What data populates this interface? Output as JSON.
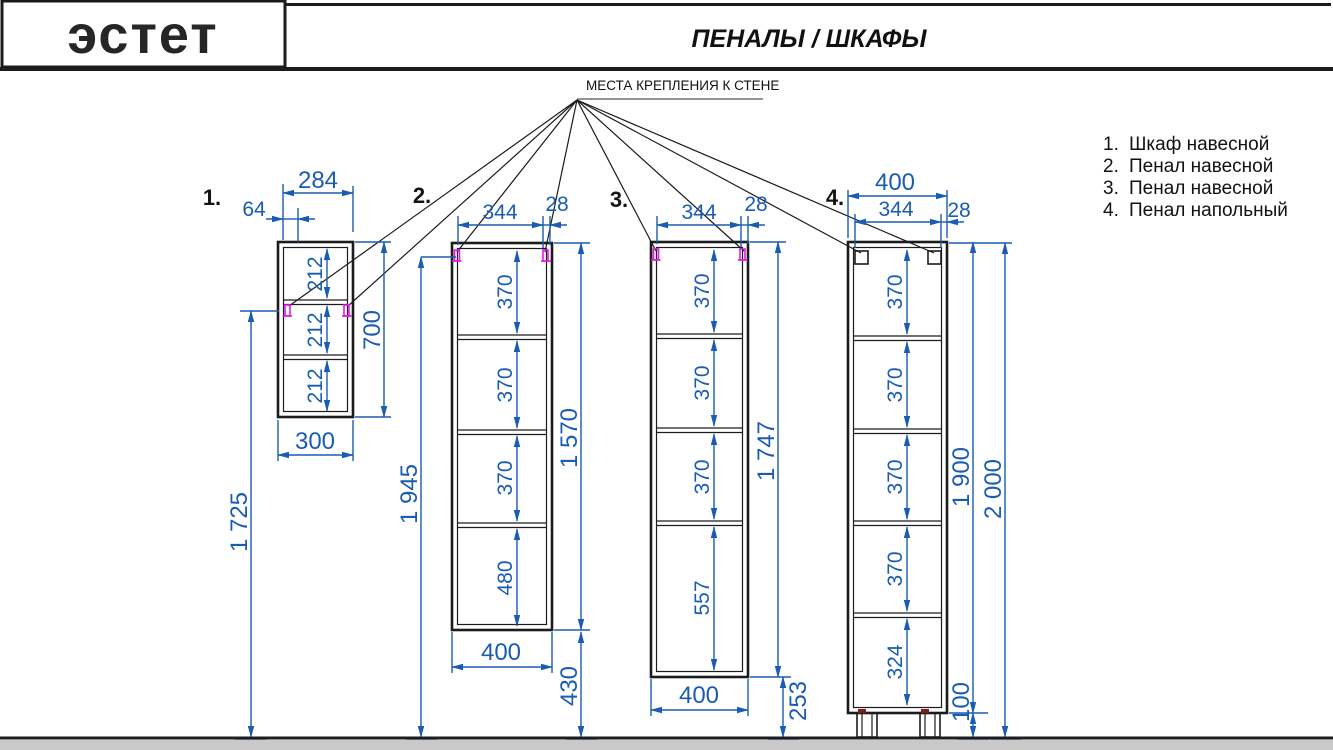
{
  "header": {
    "logo": "эстет",
    "title": "ПЕНАЛЫ / ШКАФЫ"
  },
  "wall_mount_note": "МЕСТА КРЕПЛЕНИЯ К СТЕНЕ",
  "legend": {
    "items": [
      {
        "num": "1.",
        "label": "Шкаф навесной"
      },
      {
        "num": "2.",
        "label": "Пенал навесной"
      },
      {
        "num": "3.",
        "label": "Пенал навесной"
      },
      {
        "num": "4.",
        "label": "Пенал напольный"
      }
    ]
  },
  "colors": {
    "dimension_blue": "#1a5cb4",
    "clip_magenta": "#e41ae4",
    "line_black": "#1c1c1c",
    "floor_gray": "#c9c9c9"
  },
  "cabinets": [
    {
      "num": "1.",
      "name": "Шкаф навесной",
      "dims": {
        "top_width": "284",
        "mount_offset": "64",
        "sections": [
          "212",
          "212",
          "212"
        ],
        "height": "700",
        "bottom_width": "300",
        "mount_to_floor": "1 725"
      }
    },
    {
      "num": "2.",
      "name": "Пенал навесной",
      "dims": {
        "top_width": "344",
        "panel": "28",
        "sections": [
          "370",
          "370",
          "370",
          "480"
        ],
        "height": "1 570",
        "bottom_width": "400",
        "to_floor": "430",
        "mount_to_floor": "1 945"
      }
    },
    {
      "num": "3.",
      "name": "Пенал навесной",
      "dims": {
        "top_width": "344",
        "panel": "28",
        "sections": [
          "370",
          "370",
          "370",
          "557"
        ],
        "height": "1 747",
        "bottom_width": "400",
        "to_floor": "253"
      }
    },
    {
      "num": "4.",
      "name": "Пенал напольный",
      "dims": {
        "overall_width": "400",
        "top_width": "344",
        "panel": "28",
        "sections": [
          "370",
          "370",
          "370",
          "370",
          "324"
        ],
        "body_height": "1 900",
        "overall_height": "2 000",
        "leg_height": "100"
      }
    }
  ]
}
